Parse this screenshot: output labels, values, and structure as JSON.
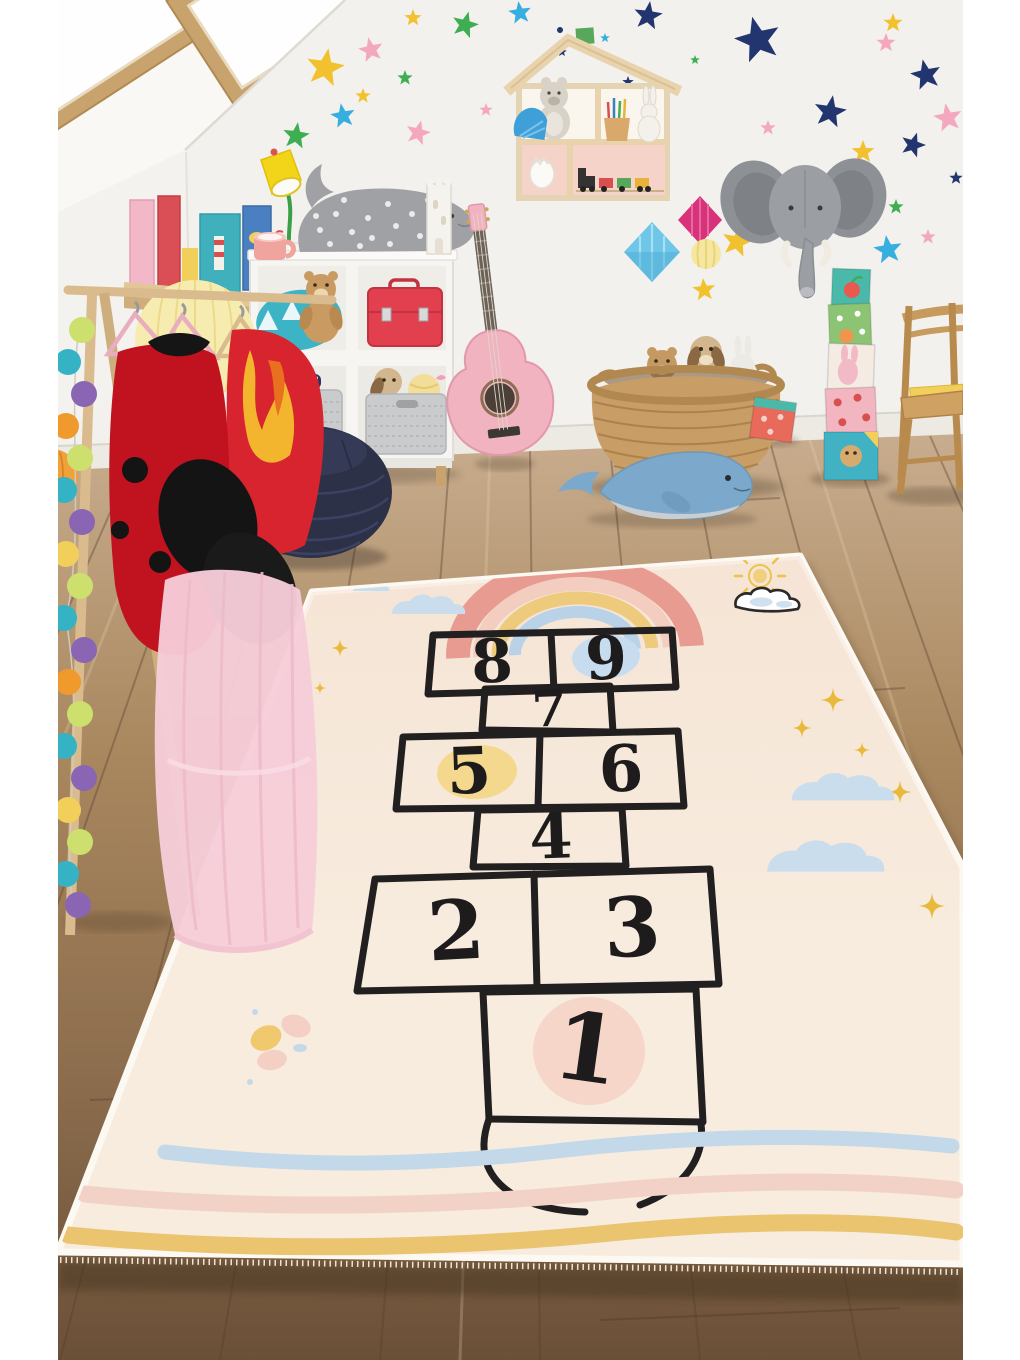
{
  "image": {
    "kind": "product photograph",
    "subject": "kids attic playroom with a hopscotch play rug on a wood floor"
  },
  "rug": {
    "name": "hopscotch play rug",
    "base_color": "#f7ecde",
    "line_color": "#211f20",
    "rows_far_to_near": [
      [
        "8",
        "9"
      ],
      [
        "7"
      ],
      [
        "5",
        "6"
      ],
      [
        "4"
      ],
      [
        "2",
        "3"
      ],
      [
        "1"
      ]
    ],
    "cells": [
      {
        "label": "8",
        "highlight": "none"
      },
      {
        "label": "9",
        "highlight": "#c7dcee"
      },
      {
        "label": "7",
        "highlight": "none"
      },
      {
        "label": "5",
        "highlight": "#f3d88e"
      },
      {
        "label": "6",
        "highlight": "none"
      },
      {
        "label": "4",
        "highlight": "none"
      },
      {
        "label": "2",
        "highlight": "none"
      },
      {
        "label": "3",
        "highlight": "none"
      },
      {
        "label": "1",
        "highlight": "#f6d6c9"
      }
    ],
    "highlights": {
      "nine": "#c7dcee",
      "five": "#f3d88e",
      "one": "#f6d6c9"
    },
    "wave_colors": [
      "#c3d8e8",
      "#f2d2c6",
      "#eac46f"
    ],
    "rainbow_colors": [
      "#e89b90",
      "#f3cdc0",
      "#eecb7c",
      "#b9d2e8"
    ],
    "decorations": [
      "rainbow",
      "sun doodle",
      "outlined cloud",
      "blue clouds",
      "gold sparkle stars",
      "pastel butterfly",
      "three wavy stripes",
      "half-circle home arc",
      "white fringe edge"
    ]
  },
  "room": {
    "wall_color": "#f3f1ed",
    "floor_colors": [
      "#c9ae90",
      "#a9885f",
      "#6b5038"
    ],
    "star_decal_colors": [
      "#f2c12e",
      "#f4a8c0",
      "#23356f",
      "#3fae52",
      "#36aee0"
    ],
    "objects": [
      "two skylight windows on sloped ceiling",
      "colorful star wall decals",
      "house-shaped wall shelf with teddy bear, pencils, bunny and toy train",
      "felt elephant head wall mount",
      "paper honeycomb decorations",
      "yellow desk lamp",
      "wall book rack with picture books",
      "gray polka-dot whale cushion",
      "pink mug",
      "white castle toy",
      "white cube storage shelf with teal pillow, teddy, red suitcase and gray baskets",
      "pink acoustic guitar",
      "navy knitted pouf",
      "wooden clothes rack with ladybug costume, flame costume and pink tutu",
      "pom-pom garland",
      "wicker basket with plush toys",
      "blue whale plush",
      "stacking block tower",
      "toy block",
      "wooden children chair with books"
    ]
  }
}
